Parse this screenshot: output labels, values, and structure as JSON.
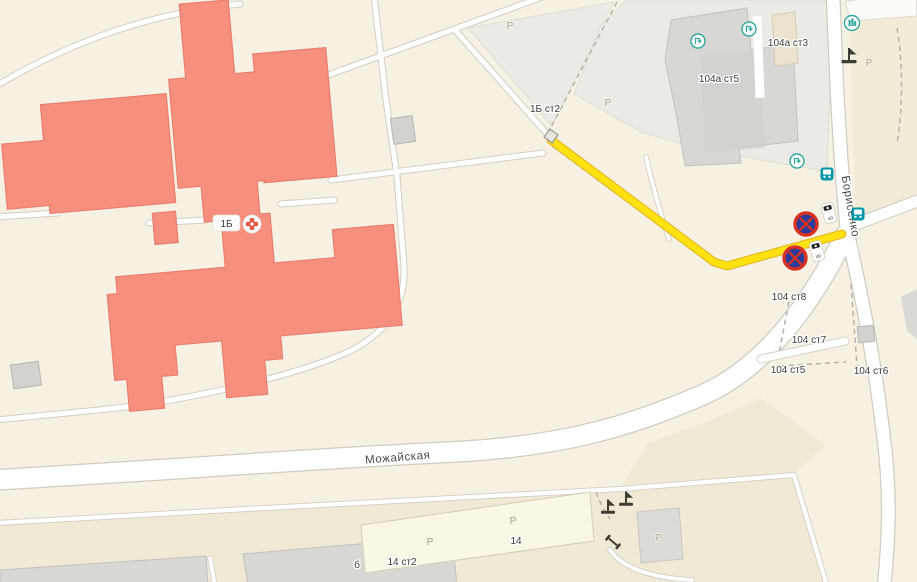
{
  "map": {
    "type": "city-map-fragment",
    "streets": {
      "horizontal": "Можайская",
      "vertical": "Борисенко"
    },
    "hospital": {
      "number": "1Б",
      "annex": "1Б ст2",
      "poi": "hospital-cross-icon"
    },
    "buildings": {
      "b104a5": "104а ст5",
      "b104a3": "104а ст3",
      "b104_8": "104 ст8",
      "b104_7": "104 ст7",
      "b104_5": "104 ст5",
      "b104_6": "104 ст6",
      "b14": "14",
      "b14_2": "14 ст2",
      "b_letter": "б"
    },
    "parking_label": "Р",
    "camera_badge_label": "40",
    "route": {
      "color": "#ffe20f",
      "kind": "highlighted-walk-drive-route",
      "start_marker": "small-square-gate-marker"
    },
    "road_signs": {
      "no_stopping_count": 2,
      "speed_camera_count": 2
    },
    "icons": {
      "bus_stop_count": 2,
      "entrance_count": 3,
      "teal_poi_count": 1,
      "barrier_count": 3,
      "dumbbell_count": 1
    },
    "colors": {
      "background": "#f6f1e2",
      "paved_area": "#f0e9d5",
      "hospital_fill": "#f78f7f",
      "hospital_stroke": "#e87f71",
      "road_fill": "#ffffff",
      "road_casing": "#cfccc3",
      "gray_building": "#d8d7d4",
      "teal": "#2fa89b",
      "bus_teal": "#0097a8",
      "sign_blue": "#2a3b9b",
      "sign_red": "#d63122",
      "route_yellow": "#ffe20f"
    }
  }
}
